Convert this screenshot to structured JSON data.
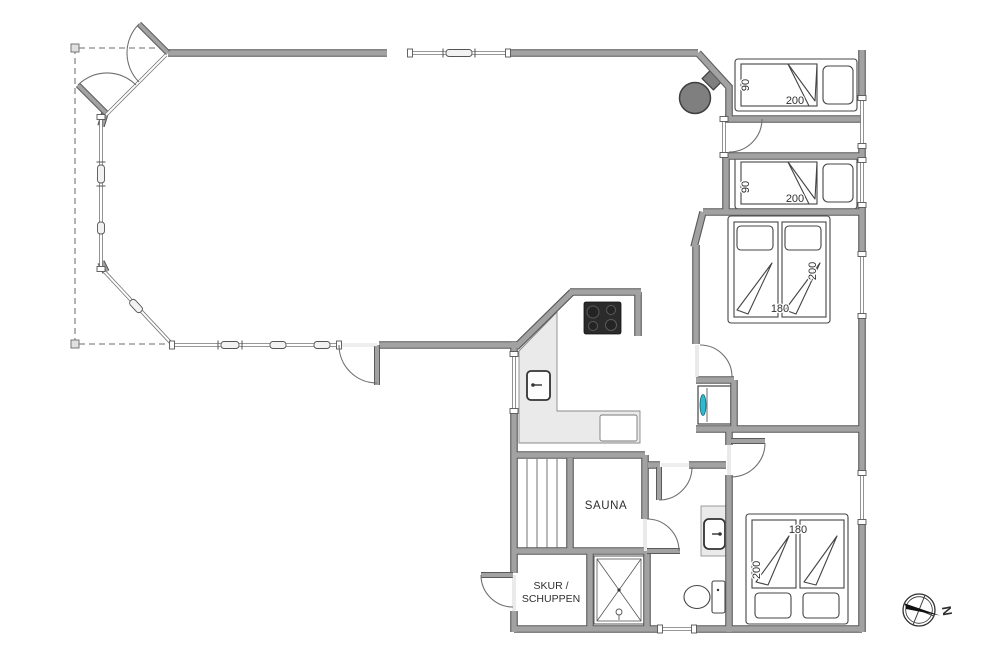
{
  "floorplan": {
    "rooms": {
      "sauna": "SAUNA",
      "shed_line1": "SKUR /",
      "shed_line2": "SCHUPPEN"
    },
    "bed_dimensions": {
      "single_bed_top": {
        "width": "90",
        "length": "200"
      },
      "single_bed_second": {
        "width": "90",
        "length": "200"
      },
      "double_bed_middle": {
        "width": "180",
        "length": "200"
      },
      "double_bed_bottom": {
        "width": "180",
        "length": "200"
      }
    },
    "compass": {
      "north": "N"
    },
    "colors": {
      "wall_fill": "#a2a2a2",
      "wall_edge": "#5a5a5a",
      "counter_fill": "#eaeaea",
      "cooktop": "#2b2b2b",
      "wood_stove": "#7f7f7f",
      "washer_accent": "#2fb9cf"
    }
  }
}
